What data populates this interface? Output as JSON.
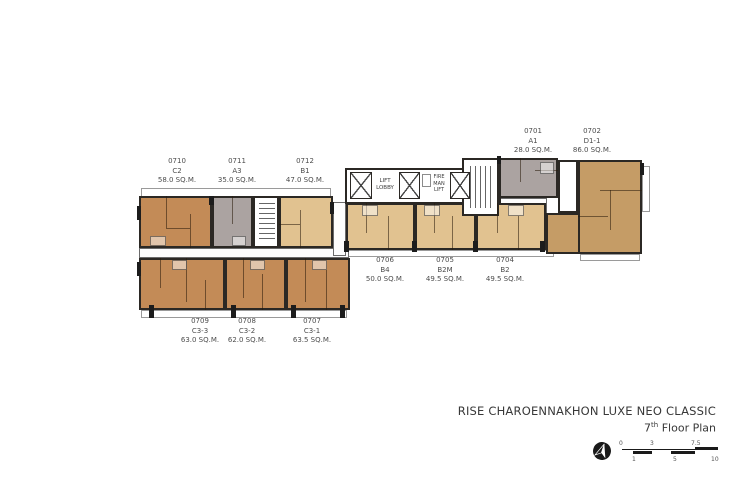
{
  "title": {
    "name": "RISE CHAROENNAKHON LUXE NEO CLASSIC",
    "floor_number": "7",
    "floor_suffix": "th",
    "floor_label": " Floor Plan"
  },
  "units": [
    {
      "id": "0701",
      "type": "A1",
      "area": "28.0 SQ.M."
    },
    {
      "id": "0702",
      "type": "D1-1",
      "area": "86.0 SQ.M."
    },
    {
      "id": "0710",
      "type": "C2",
      "area": "58.0 SQ.M."
    },
    {
      "id": "0711",
      "type": "A3",
      "area": "35.0 SQ.M."
    },
    {
      "id": "0712",
      "type": "B1",
      "area": "47.0 SQ.M."
    },
    {
      "id": "0706",
      "type": "B4",
      "area": "50.0 SQ.M."
    },
    {
      "id": "0705",
      "type": "B2M",
      "area": "49.5 SQ.M."
    },
    {
      "id": "0704",
      "type": "B2",
      "area": "49.5 SQ.M."
    },
    {
      "id": "0709",
      "type": "C3-3",
      "area": "63.0 SQ.M."
    },
    {
      "id": "0708",
      "type": "C3-2",
      "area": "62.0 SQ.M."
    },
    {
      "id": "0707",
      "type": "C3-1",
      "area": "63.5 SQ.M."
    }
  ],
  "core": {
    "lift_lobby": [
      "LIFT",
      "LOBBY"
    ],
    "fireman_lift": [
      "FIRE",
      "MAN",
      "LIFT"
    ]
  },
  "scalebar": {
    "top": [
      "0",
      "3",
      "7.5"
    ],
    "bottom": [
      "1",
      "5",
      "10"
    ]
  },
  "colors": {
    "unit_orange": "#c38b57",
    "unit_gray": "#aba3a1",
    "unit_beige": "#e1c290",
    "unit_tan": "#c59c66",
    "wall": "#2b2824"
  }
}
